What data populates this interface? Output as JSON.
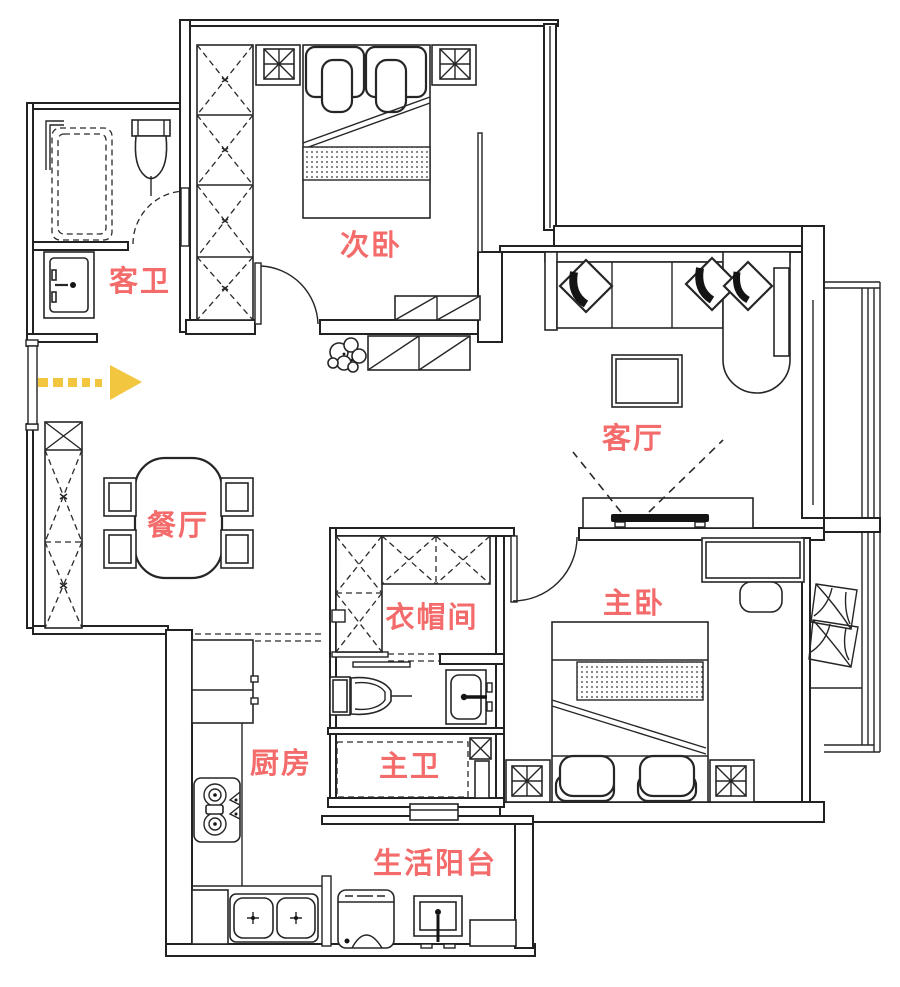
{
  "meta": {
    "type": "apartment-floor-plan",
    "background_color": "#ffffff",
    "wall_color": "#222222",
    "label_color": "#f46b6b",
    "arrow_color": "#f2c63f"
  },
  "rooms": [
    {
      "id": "guest-bathroom",
      "label": "客卫",
      "furniture": [
        "shower-area",
        "toilet",
        "washbasin",
        "folding-door"
      ]
    },
    {
      "id": "secondary-bedroom",
      "label": "次卧",
      "furniture": [
        "wardrobe",
        "double-bed",
        "nightstand-left",
        "nightstand-right",
        "foot-cabinet",
        "door"
      ]
    },
    {
      "id": "living-room",
      "label": "客厅",
      "furniture": [
        "sofa",
        "chaise",
        "throw-pillows",
        "side-table",
        "coffee-table",
        "tv-cabinet",
        "tv",
        "plant",
        "hallway-cabinet"
      ]
    },
    {
      "id": "dining-room",
      "label": "餐厅",
      "furniture": [
        "dining-table",
        "chair-x4",
        "shoe-cabinet"
      ]
    },
    {
      "id": "cloakroom",
      "label": "衣帽间",
      "furniture": [
        "l-shaped-wardrobe",
        "sliding-opening"
      ]
    },
    {
      "id": "master-bedroom",
      "label": "主卧",
      "furniture": [
        "double-bed",
        "nightstand-left",
        "nightstand-right",
        "desk",
        "chair",
        "bay-window-cushions",
        "door"
      ]
    },
    {
      "id": "kitchen",
      "label": "厨房",
      "furniture": [
        "fridge",
        "gas-stove",
        "counter",
        "double-sink",
        "sliding-door"
      ]
    },
    {
      "id": "master-bathroom",
      "label": "主卫",
      "furniture": [
        "toilet",
        "washbasin",
        "shower-area",
        "vent-shaft"
      ]
    },
    {
      "id": "service-balcony",
      "label": "生活阳台",
      "furniture": [
        "washing-machine",
        "mop-basin",
        "shelf",
        "door-leaf"
      ]
    }
  ],
  "entry": {
    "arrow_direction": "right"
  }
}
